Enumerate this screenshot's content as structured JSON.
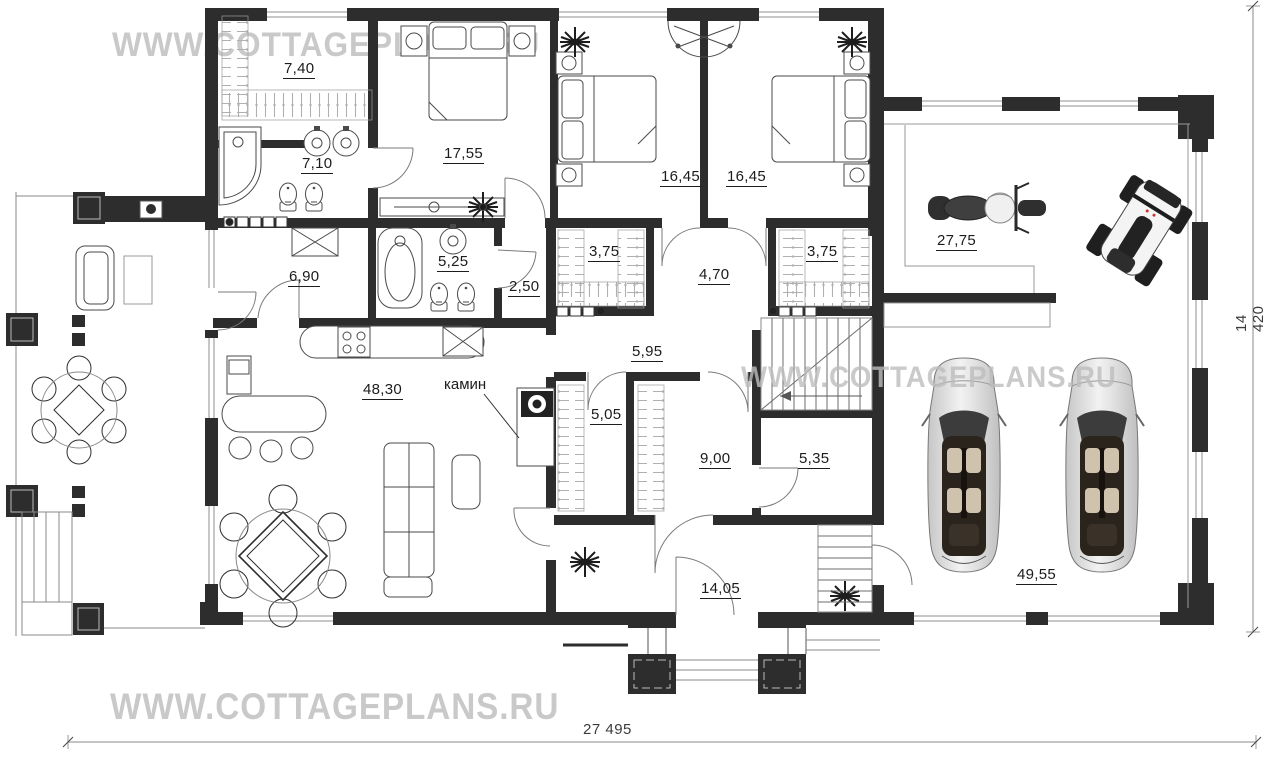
{
  "watermarks": {
    "top": "WWW.COTTAGEPLANS.RU",
    "middle": "WWW.COTTAGEPLANS.RU",
    "bottom": "WWW.COTTAGEPLANS.RU"
  },
  "rooms": [
    {
      "name": "wardrobe-top",
      "area": "7,40"
    },
    {
      "name": "bathroom-master",
      "area": "7,10"
    },
    {
      "name": "bedroom-master",
      "area": "17,55"
    },
    {
      "name": "bedroom-2",
      "area": "16,45"
    },
    {
      "name": "bedroom-3",
      "area": "16,45"
    },
    {
      "name": "moto-garage",
      "area": "27,75"
    },
    {
      "name": "pantry",
      "area": "6,90"
    },
    {
      "name": "bathroom-2",
      "area": "5,25"
    },
    {
      "name": "hall-small",
      "area": "2,50"
    },
    {
      "name": "wardrobe-left",
      "area": "3,75"
    },
    {
      "name": "hall-center",
      "area": "4,70"
    },
    {
      "name": "wardrobe-right",
      "area": "3,75"
    },
    {
      "name": "corridor",
      "area": "5,95"
    },
    {
      "name": "living-room",
      "area": "48,30"
    },
    {
      "name": "closet",
      "area": "5,05"
    },
    {
      "name": "entry-hall",
      "area": "9,00"
    },
    {
      "name": "storage",
      "area": "5,35"
    },
    {
      "name": "vestibule",
      "area": "14,05"
    },
    {
      "name": "car-garage",
      "area": "49,55"
    }
  ],
  "annotations": {
    "fireplace": "камин"
  },
  "dimensions": {
    "width": "27 495",
    "height": "14 420"
  },
  "colors": {
    "wall": "#2d2d2d",
    "thin_line": "#8a8a8a",
    "hatch": "#b0b0b0",
    "watermark": "#c9c9c9",
    "label": "#1c1c1c"
  }
}
